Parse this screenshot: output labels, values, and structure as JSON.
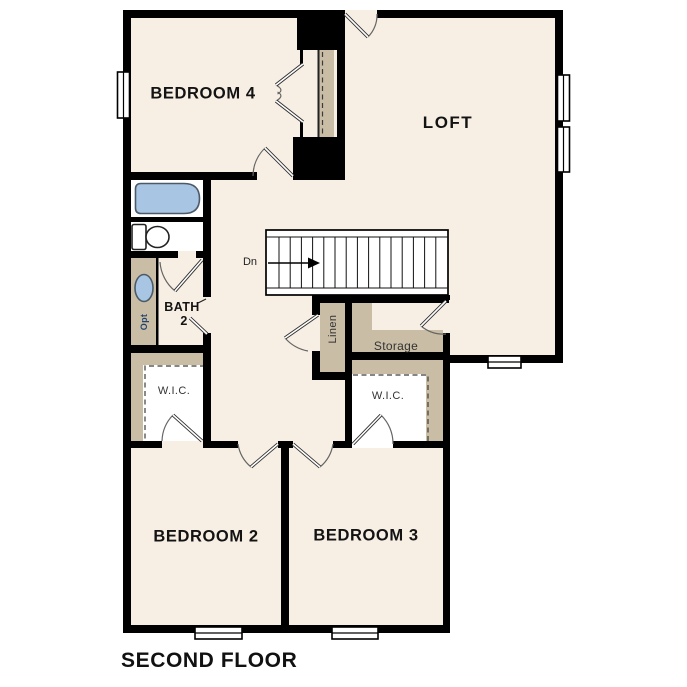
{
  "plan_title": "SECOND FLOOR",
  "palette": {
    "floor": "#f7efe4",
    "wall": "#000000",
    "casework": "#c9bda5",
    "fixture_blue": "#a8c6e4",
    "line": "#333333",
    "background": "#ffffff"
  },
  "rooms": {
    "bedroom4": "BEDROOM 4",
    "loft": "LOFT",
    "bath2_line1": "BATH",
    "bath2_line2": "2",
    "wic_left": "W.I.C.",
    "wic_right": "W.I.C.",
    "linen": "Linen",
    "storage": "Storage",
    "bedroom2": "BEDROOM 2",
    "bedroom3": "BEDROOM 3"
  },
  "annotations": {
    "stairs_direction": "Dn",
    "vanity_option": "Opt"
  }
}
